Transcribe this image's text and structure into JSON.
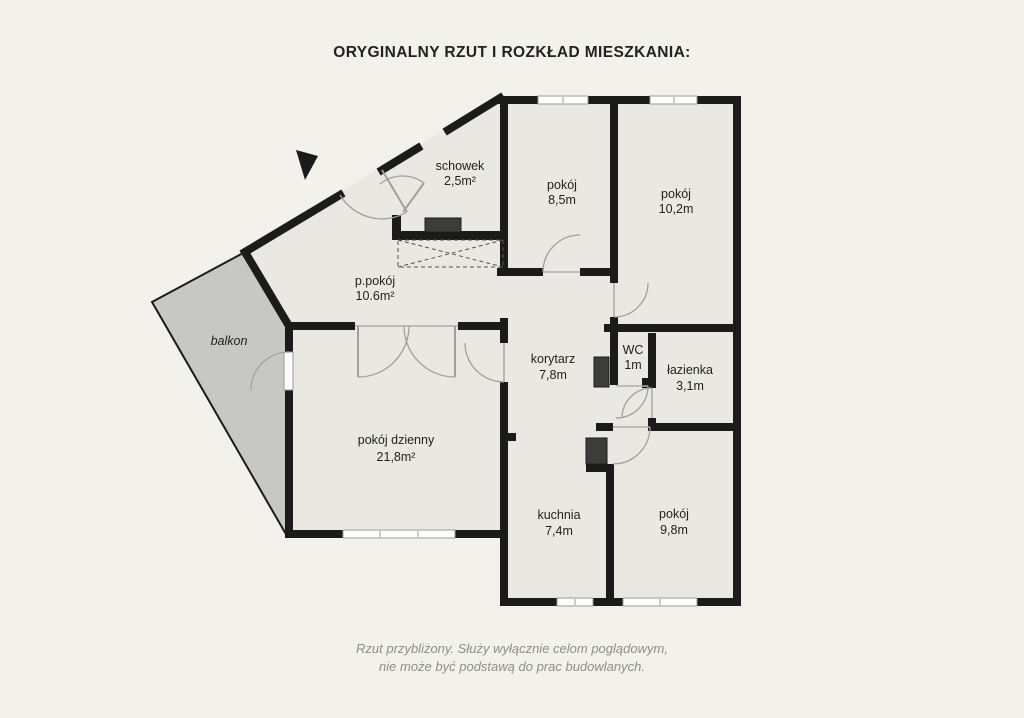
{
  "title": "ORYGINALNY RZUT I ROZKŁAD MIESZKANIA:",
  "rooms": [
    {
      "name": "schowek",
      "area": "2,5m²"
    },
    {
      "name": "pokój",
      "area": "8,5m"
    },
    {
      "name": "pokój",
      "area": "10,2m"
    },
    {
      "name": "p.pokój",
      "area": "10.6m²"
    },
    {
      "name": "balkon",
      "area": ""
    },
    {
      "name": "korytarz",
      "area": "7,8m"
    },
    {
      "name": "WC",
      "area": "1m"
    },
    {
      "name": "łazienka",
      "area": "3,1m"
    },
    {
      "name": "pokój dzienny",
      "area": "21,8m²"
    },
    {
      "name": "kuchnia",
      "area": "7,4m"
    },
    {
      "name": "pokój",
      "area": "9,8m"
    }
  ],
  "footer": {
    "line1": "Rzut przybliżony. Służy wyłącznie celom poglądowym,",
    "line2": "nie może być podstawą do prac budowlanych."
  },
  "colors": {
    "background": "#f2f1ec",
    "floor": "#e9e8e3",
    "balcony": "#c7c7c4",
    "wall": "#1b1b19",
    "door": "#a0a09c",
    "duct": "#3c3c3a",
    "text": "#222220",
    "muted": "#8e8e8a"
  }
}
